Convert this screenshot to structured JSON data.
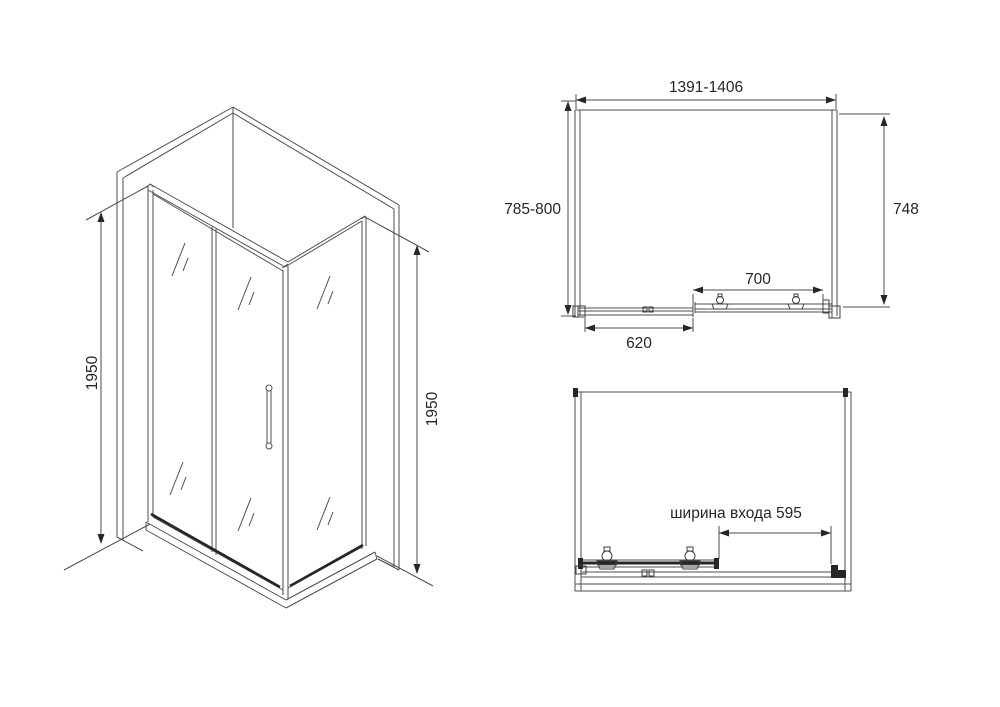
{
  "drawing": {
    "colors": {
      "line": "#4d4d4d",
      "dark_line": "#262626",
      "text": "#262626",
      "background": "#ffffff"
    },
    "iso_view": {
      "height_left": "1950",
      "height_right": "1950"
    },
    "plan_view": {
      "width_range": "1391-1406",
      "depth_range": "785-800",
      "depth_glass": "748",
      "door_width": "700",
      "fixed_width": "620"
    },
    "open_view": {
      "entrance_width_label": "ширина входа 595"
    }
  }
}
